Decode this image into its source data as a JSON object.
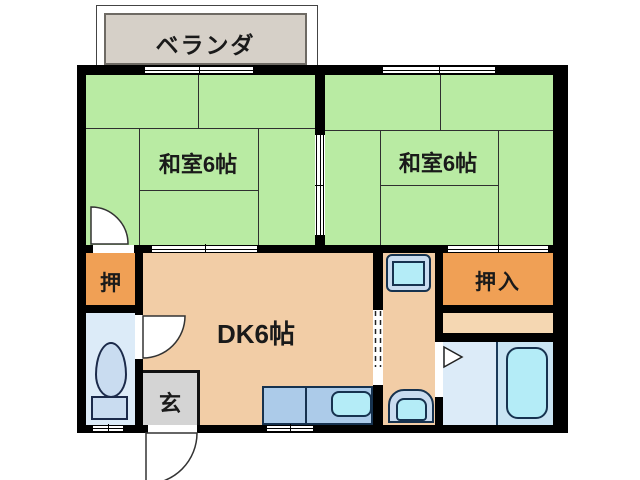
{
  "plan_title": "2DK apartment floor plan",
  "rooms": {
    "veranda": {
      "label": "ベランダ"
    },
    "washitsu_left": {
      "label": "和室6帖"
    },
    "washitsu_right": {
      "label": "和室6帖"
    },
    "dk": {
      "label": "DK6帖"
    },
    "oshi": {
      "label": "押"
    },
    "oshiire": {
      "label": "押入"
    },
    "genkan": {
      "label": "玄"
    }
  },
  "fixtures": {
    "toilet": "toilet",
    "bathtub": "bathtub",
    "kitchen_sink": "kitchen counter with sink",
    "washbasin": "washbasin",
    "washing_machine_pan": "washing machine pan"
  },
  "colors": {
    "wall": "#000000",
    "tatami_room": "#b9eba3",
    "closet_orange": "#f0a055",
    "dk_tan": "#f2cda6",
    "shelf_tan": "#f5d7b2",
    "genkan_gray": "#d4d4d4",
    "veranda_gray": "#d6d0c8",
    "toilet_blue": "#dcebf8",
    "bath_blue": "#c9e4f3",
    "fixture_cyan": "#b4ecf7",
    "fixture_blue": "#c9dcf0",
    "counter_blue": "#accbe9"
  }
}
